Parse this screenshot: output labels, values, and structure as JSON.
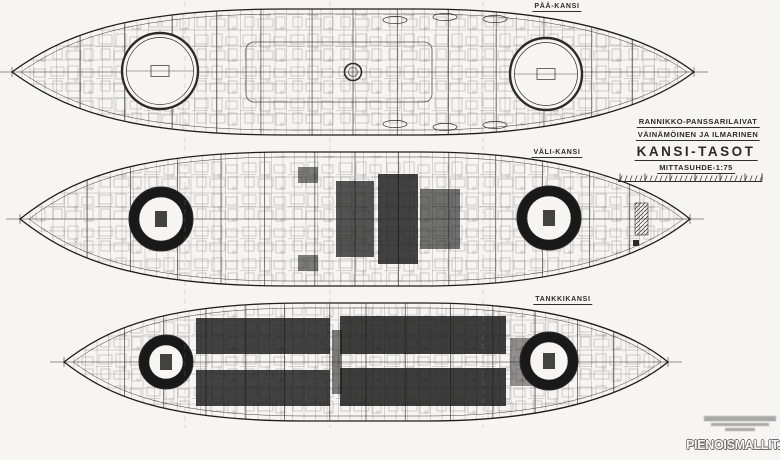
{
  "drawing": {
    "decks": [
      {
        "id": "paa-kansi",
        "label": "PÄÄ-KANSI"
      },
      {
        "id": "vali-kansi",
        "label": "VÄLI-KANSI"
      },
      {
        "id": "tankkikansi",
        "label": "TANKKIKANSI"
      }
    ],
    "title_block": {
      "class_line": "RANNIKKO-PANSSARILAIVAT",
      "ships_line": "VÄINÄMÖINEN JA ILMARINEN",
      "title": "KANSI-TASOT",
      "scale_note": "MITTASUHDE-1:75"
    },
    "watermark": "PIENOISMALLIT.NET",
    "colors": {
      "ink": "#2b2b2b",
      "paper": "#f6f5f2"
    }
  }
}
